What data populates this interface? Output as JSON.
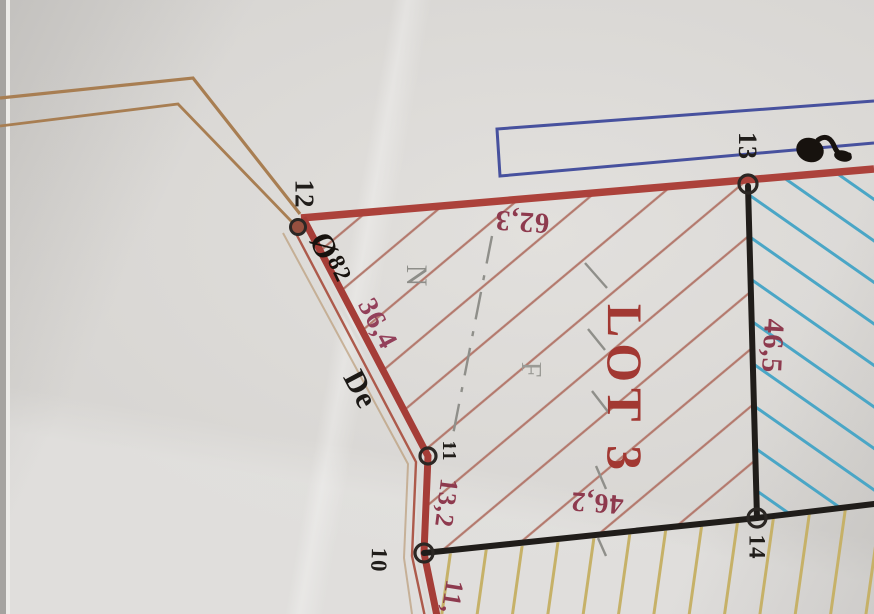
{
  "map": {
    "lot_title": "LOT 3",
    "points": [
      {
        "id": "12"
      },
      {
        "id": "13"
      },
      {
        "id": "11"
      },
      {
        "id": "10"
      },
      {
        "id": "14"
      }
    ],
    "dimensions": [
      {
        "value": "62,3"
      },
      {
        "value": "46,5"
      },
      {
        "value": "36,4"
      },
      {
        "value": "13,2"
      },
      {
        "value": "46,2"
      },
      {
        "value": "11,"
      }
    ],
    "annotations": {
      "road_label": "De",
      "diameter_symbol": "Ø",
      "diameter_value": "82",
      "letter_n": "N",
      "letter_f": "F"
    },
    "colors": {
      "boundary_red": "#a8403a",
      "hatch_red": "#b47a6e",
      "hatch_cyan": "#4aa6c6",
      "hatch_yellow": "#c6b168",
      "frame_blue": "#47519e",
      "road_tan": "#a87e52",
      "dimension_maroon": "#8e3a4e",
      "lot_red": "#a23832",
      "ink_black": "#1d1b19",
      "pencil_gray": "#8d8d88",
      "paper": "#d7d5d2"
    }
  }
}
